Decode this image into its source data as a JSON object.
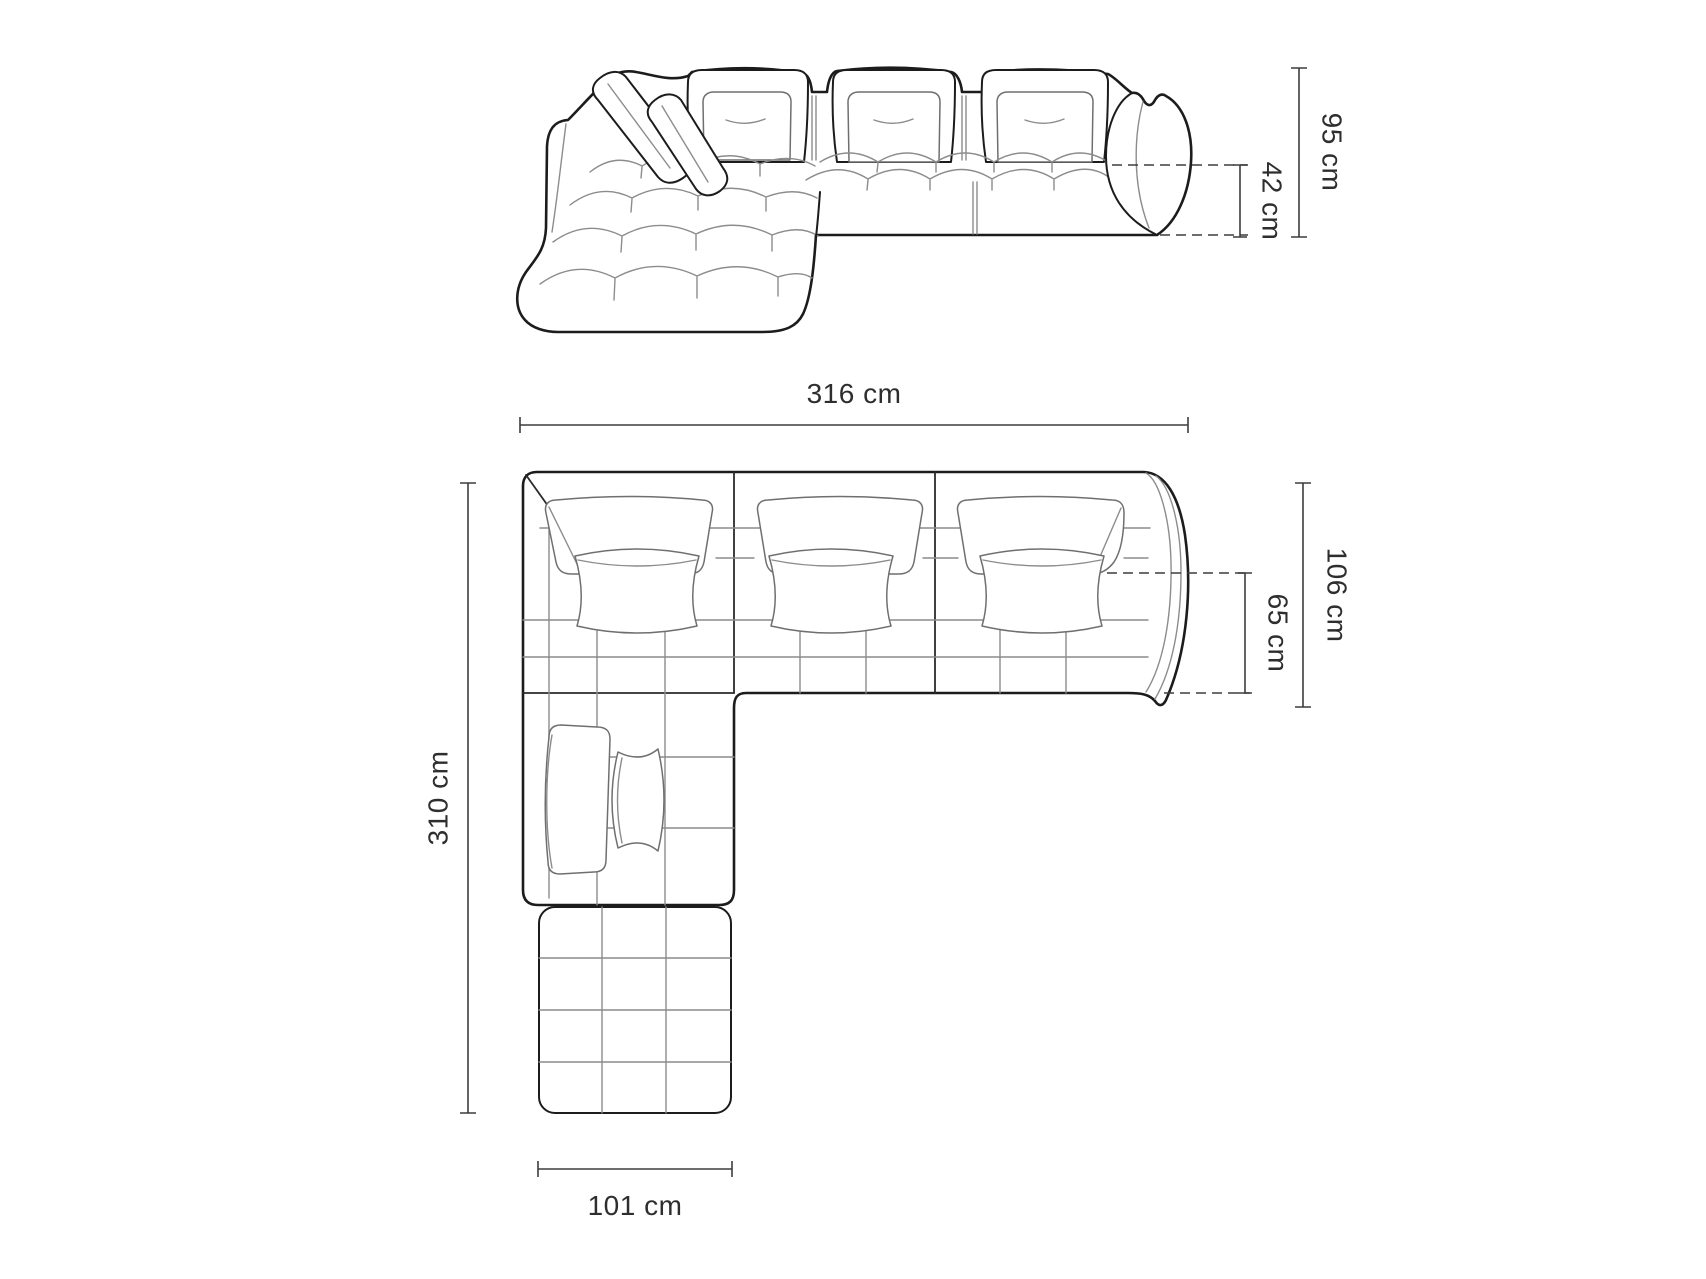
{
  "page": {
    "kind": "product dimension diagram",
    "subject": "modular corner sofa with chaise",
    "background": "#ffffff"
  },
  "views": {
    "side_view": {
      "name": "side-elevation-view",
      "dimensions": {
        "total_height": {
          "label": "95 cm"
        },
        "seat_height": {
          "label": "42 cm"
        }
      }
    },
    "top_view": {
      "name": "top-plan-view",
      "dimensions": {
        "total_width": {
          "label": "316 cm"
        },
        "total_depth": {
          "label": "106 cm"
        },
        "seat_depth": {
          "label": "65 cm"
        },
        "total_length": {
          "label": "310 cm"
        },
        "chaise_width": {
          "label": "101 cm"
        }
      }
    }
  },
  "style": {
    "outline_color": "#1c1c1c",
    "detail_color": "#8c8c8c",
    "dimension_color": "#3d3d3d",
    "text_color": "#2e2e2e"
  }
}
